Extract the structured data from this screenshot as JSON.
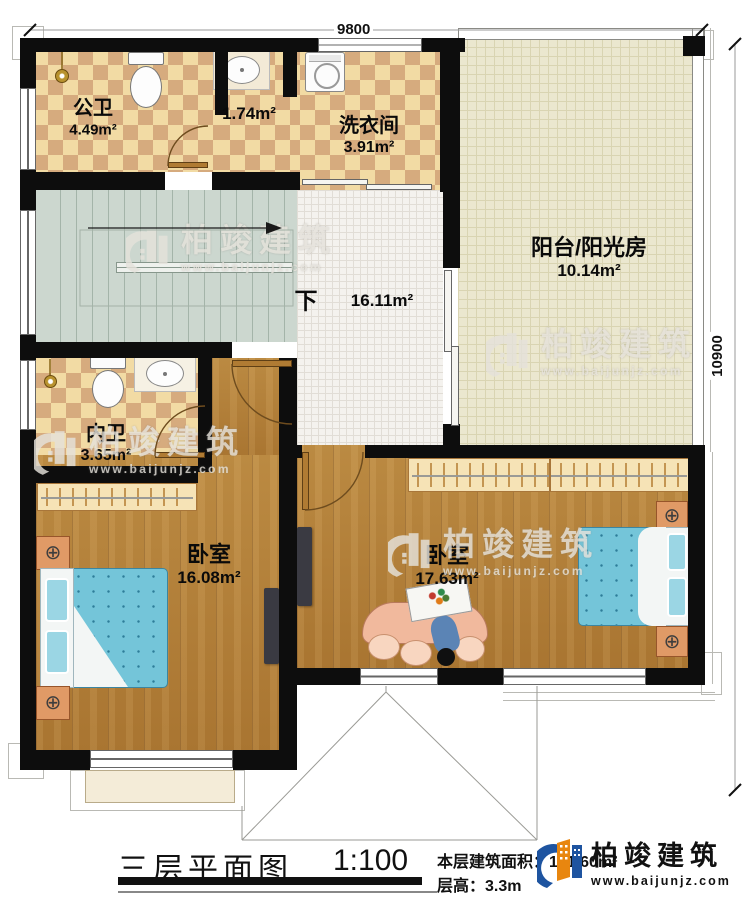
{
  "plan": {
    "dimensions": {
      "top": "9800",
      "right": "10900"
    },
    "rooms": {
      "gongwei": {
        "name": "公卫",
        "area": "4.49m²"
      },
      "storage": {
        "area": "1.74m²"
      },
      "laundry": {
        "name": "洗衣间",
        "area": "3.91m²"
      },
      "balcony": {
        "name": "阳台/阳光房",
        "area": "10.14m²"
      },
      "hall": {
        "direction": "下",
        "area": "16.11m²"
      },
      "neiwei": {
        "name": "内卫",
        "area": "3.65m²"
      },
      "bedroom1": {
        "name": "卧室",
        "area": "16.08m²"
      },
      "bedroom2": {
        "name": "卧室",
        "area": "17.63m²"
      }
    },
    "watermark": {
      "brand": "柏竣建筑",
      "url": "www.baijunjz.com"
    }
  },
  "footer": {
    "title": "三层平面图",
    "scale": "1:100",
    "area_label": "本层建筑面积：",
    "area_value": "101.60m²",
    "height_label": "层高：",
    "height_value": "3.3m",
    "logo": {
      "brand": "柏竣建筑",
      "url": "www.baijunjz.com"
    }
  },
  "icons": {
    "lamp": "⊕"
  },
  "colors": {
    "wall": "#0d0d0d",
    "tile_light": "#f2dba4",
    "tile_dark": "#d6ab7e",
    "wood": "#b5823c",
    "stair": "#ccd7cf",
    "sunroom": "#ebe7cf",
    "bed": "#74c5d9",
    "nightstand": "#e09a66",
    "sofa": "#f1b99d",
    "logo_blue": "#1e54a0",
    "logo_orange": "#e8860f"
  }
}
